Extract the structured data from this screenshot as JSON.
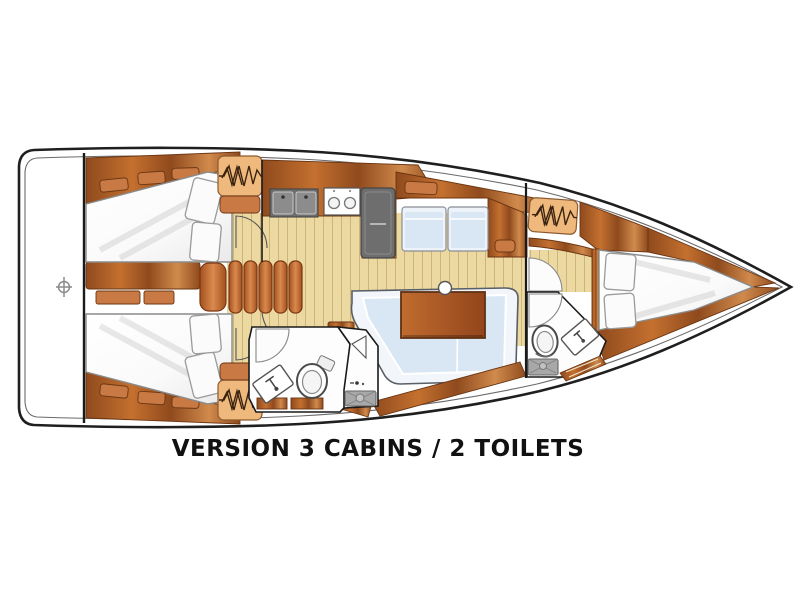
{
  "diagram": {
    "type": "yacht-floorplan-top-view",
    "caption": "VERSION 3 CABINS / 2 TOILETS",
    "cabins": 3,
    "toilets": 2,
    "areas": [
      "swim-platform",
      "aft-cabin-port",
      "aft-cabin-starboard",
      "companionway-steps",
      "galley",
      "salon",
      "starboard-settee",
      "aft-head",
      "shower-room",
      "forward-head",
      "forward-cabin"
    ],
    "fixtures": [
      "helm-symbol",
      "double-sink",
      "stove-two-burners",
      "fridge",
      "saloon-table",
      "mast-post",
      "l-shaped-sofa",
      "toilet-aft",
      "sink-aft",
      "shower-pan-aft",
      "toilet-forward",
      "sink-forward",
      "shower-pan-forward",
      "deck-hatch"
    ]
  },
  "palette": {
    "page_bg": "#ffffff",
    "hull_stroke": "#1f1f1f",
    "wall": "#1a1a1a",
    "wood_dark": "#8f4a1d",
    "wood_mid": "#c4702f",
    "wood_light": "#d08a4c",
    "wood_edge": "#6b3512",
    "locker": "#c97a44",
    "floor": "#ecd9a2",
    "floor_line": "#cdb477",
    "hatch": "#efb97d",
    "hatch_line": "#8a5a2e",
    "blue": "#d9e6f3",
    "blue_pale": "#eef3f9",
    "gray_dark": "#6e6e6e",
    "gray_mid": "#8c8c8c",
    "gray_pan": "#a8a8a8",
    "text": "#111111"
  }
}
